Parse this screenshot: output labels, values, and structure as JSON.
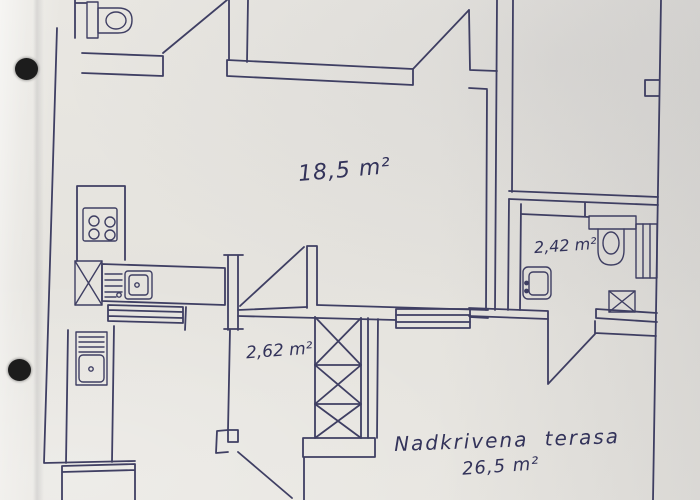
{
  "photo": {
    "description_label": "hand-drawn floor plan on hole-punched paper"
  },
  "colors": {
    "ink": "#33335a",
    "paper": "#e7e5e0",
    "hole": "#1c1c1c"
  },
  "labels": {
    "main_room_area": "18,5 m²",
    "bathroom_area": "2,42 m²",
    "hallway_area": "2,62 m²",
    "terrace_name": "Nadkrivena terasa",
    "terrace_area": "26,5 m²"
  },
  "icons": {
    "top_left_fixture": "toilet-icon",
    "bathroom_fixture": "toilet-icon",
    "kitchen_cooktop": "stove-icon",
    "kitchen_sink": "sink-icon",
    "utility_sink": "sink-icon",
    "bathroom_basin": "washbasin-icon",
    "crossed_boxes": "crossed-box-icon",
    "shaft": "hatched-shaft-icon",
    "window_symbols": "window-icon",
    "binder_holes": "punch-hole"
  }
}
